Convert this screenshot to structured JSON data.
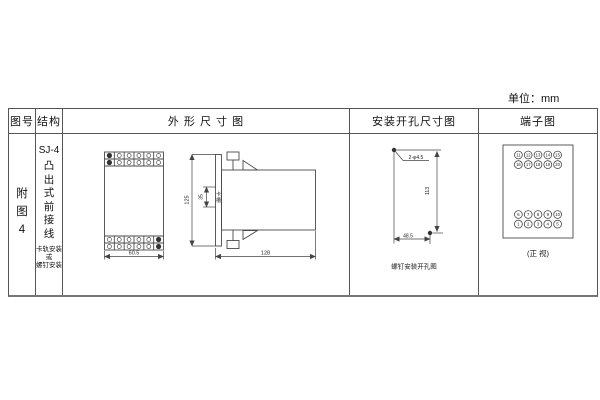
{
  "unit_label": "单位：mm",
  "table": {
    "headers": {
      "figure_no": "图号",
      "structure": "结构",
      "outline": "外 形 尺 寸 图",
      "mounting": "安装开孔尺寸图",
      "terminal": "端子图"
    },
    "figure_no": {
      "chars": [
        "附",
        "图",
        "4"
      ]
    },
    "structure": {
      "model": "SJ-4",
      "type_chars": [
        "凸",
        "出",
        "式",
        "前",
        "接",
        "线"
      ],
      "mount_lines": [
        "卡轨安装",
        "或",
        "螺钉安装"
      ]
    }
  },
  "outline": {
    "front_width": "60.5",
    "side_height": "125",
    "slot_height": "35",
    "slot_label_chars": [
      "卡",
      "槽"
    ],
    "side_depth": "128"
  },
  "mounting": {
    "hole_label": "2-φ4.5",
    "vertical": "113",
    "horizontal": "48.5",
    "caption": "螺钉安装开孔图"
  },
  "terminal": {
    "top": [
      [
        "11",
        "12",
        "13",
        "14",
        "15"
      ],
      [
        "16",
        "17",
        "18",
        "19",
        "20"
      ]
    ],
    "bottom": [
      [
        "6",
        "7",
        "8",
        "9",
        "10"
      ],
      [
        "1",
        "2",
        "3",
        "4",
        "5"
      ]
    ],
    "caption": "(正 视)"
  }
}
